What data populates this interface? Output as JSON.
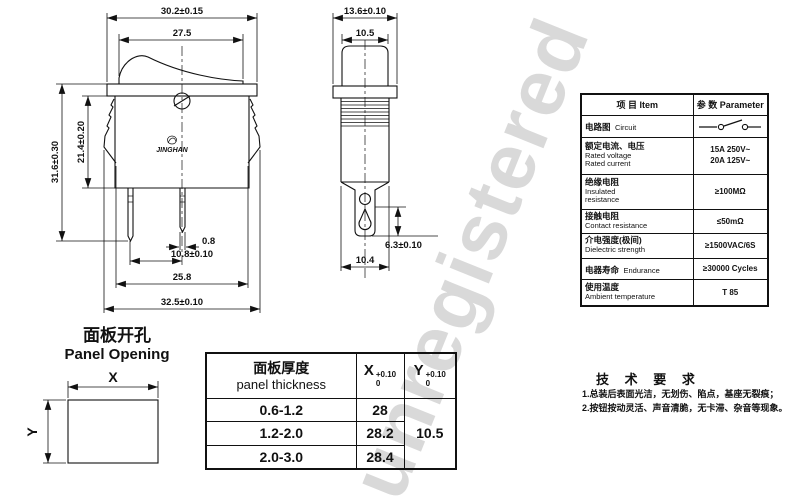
{
  "watermark": "unregistered",
  "front_view": {
    "logo": "JINGHAN",
    "dim_top_width": "30.2±0.15",
    "dim_rocker_width": "27.5",
    "dim_total_height": "31.6±0.30",
    "dim_body_height": "21.4±0.20",
    "dim_pin_thickness": "0.8",
    "dim_pin_spacing": "10.8±0.10",
    "dim_clip_span": "25.8",
    "dim_overall_width": "32.5±0.10"
  },
  "side_view": {
    "dim_flange_width": "13.6±0.10",
    "dim_rocker_width": "10.5",
    "dim_terminal_length": "6.3±0.10",
    "dim_body_width": "10.4"
  },
  "panel_opening": {
    "title_zh": "面板开孔",
    "title_en": "Panel Opening",
    "x_label": "X",
    "y_label": "Y"
  },
  "spec_table": {
    "header_item": "项 目   Item",
    "header_parameter": "参 数   Parameter",
    "rows": {
      "circuit": {
        "zh": "电路图",
        "en": "Circuit"
      },
      "rated": {
        "zh": "额定电流、电压",
        "en1": "Rated voltage",
        "en2": "Rated current",
        "value1": "15A 250V~",
        "value2": "20A 125V~"
      },
      "insulation": {
        "zh": "绝缘电阻",
        "en1": "Insulated",
        "en2": "resistance",
        "value": "≥100MΩ"
      },
      "contact": {
        "zh": "接触电阻",
        "en": "Contact resistance",
        "value": "≤50mΩ"
      },
      "dielectric": {
        "zh": "介电强度(极间)",
        "en": "Dielectric strength",
        "value": "≥1500VAC/6S"
      },
      "endurance": {
        "zh": "电器寿命",
        "en": "Endurance",
        "value": "≥30000 Cycles"
      },
      "temperature": {
        "zh": "使用温度",
        "en": "Ambient temperature",
        "value": "T 85"
      }
    }
  },
  "thickness_table": {
    "header_zh": "面板厚度",
    "header_en": "panel thickness",
    "x_symbol": "X",
    "x_tol_upper": "+0.10",
    "x_tol_lower": "0",
    "y_symbol": "Y",
    "y_tol_upper": "+0.10",
    "y_tol_lower": "0",
    "rows": [
      {
        "thickness": "0.6-1.2",
        "x": "28"
      },
      {
        "thickness": "1.2-2.0",
        "x": "28.2"
      },
      {
        "thickness": "2.0-3.0",
        "x": "28.4"
      }
    ],
    "y_value": "10.5"
  },
  "tech_requirements": {
    "title": "技 术 要 求",
    "line1": "1.总装后表面光洁，无划伤、陷点，基座无裂痕；",
    "line2": "2.按钮按动灵活、声音清脆，无卡滞、杂音等现象。"
  }
}
